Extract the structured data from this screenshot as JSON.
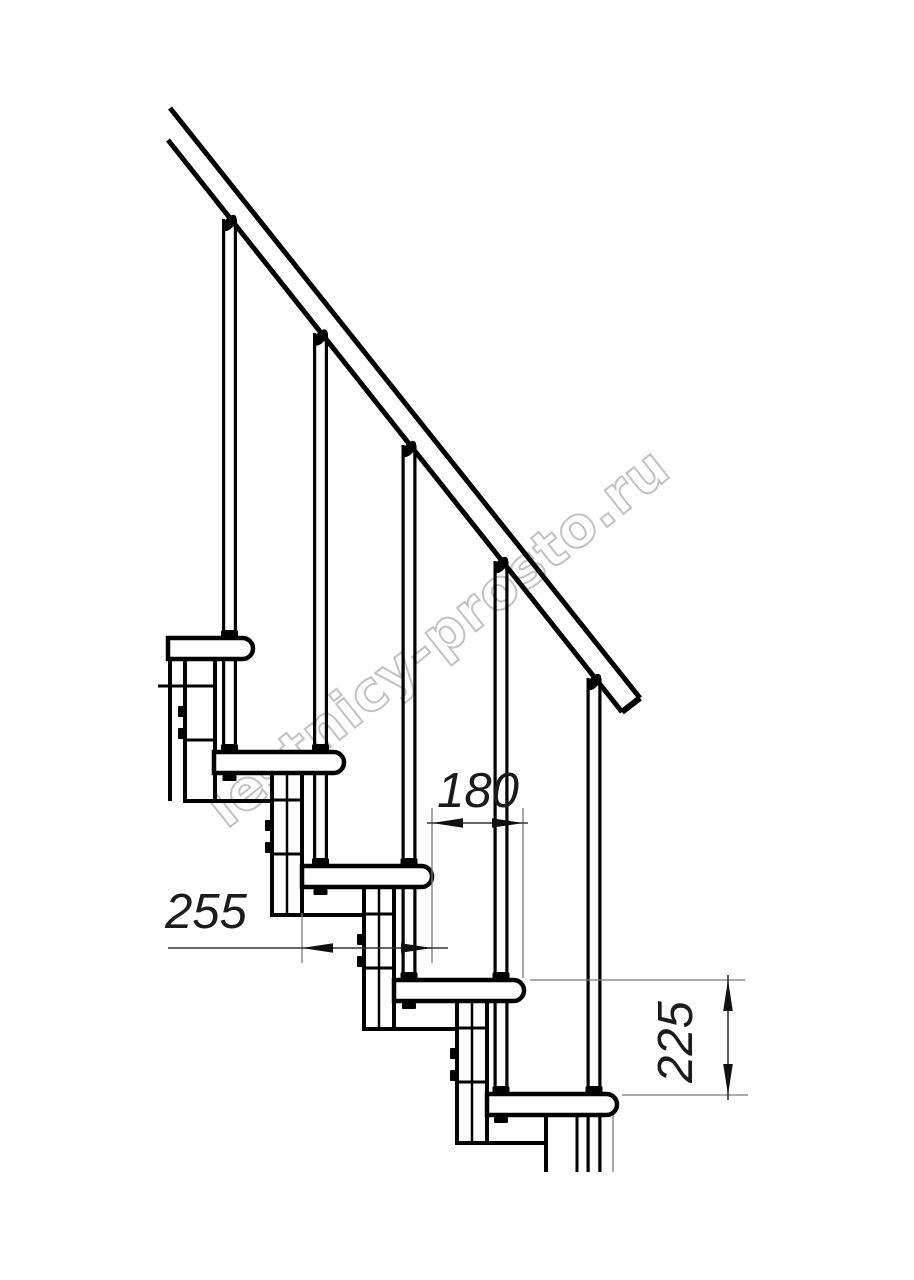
{
  "watermark": {
    "text": "lestnicy-prosto.ru",
    "color": "#c2c2c2"
  },
  "dimensions": {
    "offset_label": "180",
    "depth_label": "255",
    "rise_label": "225"
  },
  "drawing": {
    "type": "staircase-side-elevation",
    "tread_count": 5,
    "baluster_count": 5
  },
  "colors": {
    "line": "#000000",
    "dimension_line": "#333333",
    "extension_line": "#7a7a7a",
    "label": "#1b1b1b",
    "background": "#ffffff"
  }
}
